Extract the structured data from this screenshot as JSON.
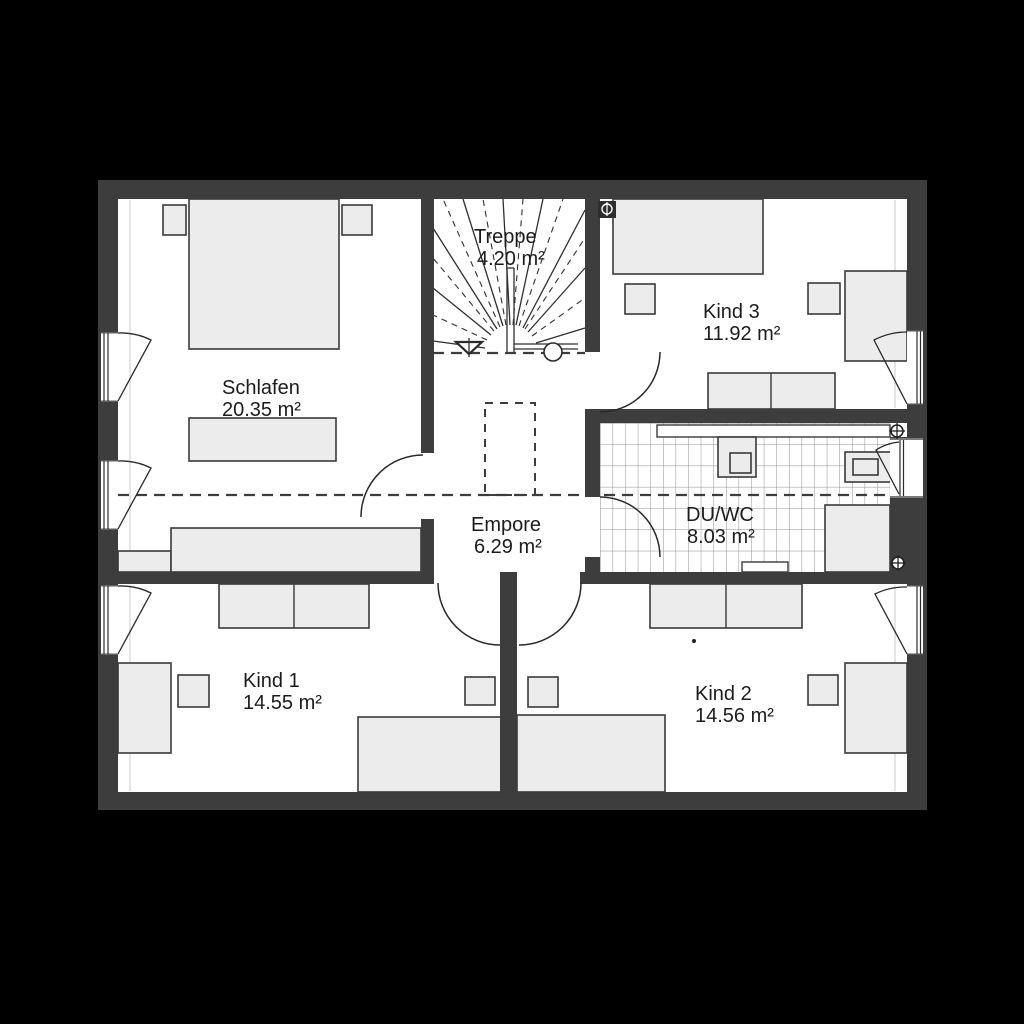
{
  "plan": {
    "type": "floor-plan",
    "rooms": [
      {
        "id": "treppe",
        "name": "Treppe",
        "area": "4.20 m²"
      },
      {
        "id": "schlafen",
        "name": "Schlafen",
        "area": "20.35 m²"
      },
      {
        "id": "kind3",
        "name": "Kind 3",
        "area": "11.92 m²"
      },
      {
        "id": "empore",
        "name": "Empore",
        "area": "6.29 m²"
      },
      {
        "id": "duwc",
        "name": "DU/WC",
        "area": "8.03 m²"
      },
      {
        "id": "kind1",
        "name": "Kind 1",
        "area": "14.55 m²"
      },
      {
        "id": "kind2",
        "name": "Kind 2",
        "area": "14.56 m²"
      }
    ],
    "colors": {
      "background": "#000000",
      "wall": "#3d3d3d",
      "floor": "#ffffff",
      "furniture": "#ececec",
      "line": "#2a2a2a",
      "tile_line": "#8f8f8f",
      "text": "#1c1c1c"
    }
  }
}
